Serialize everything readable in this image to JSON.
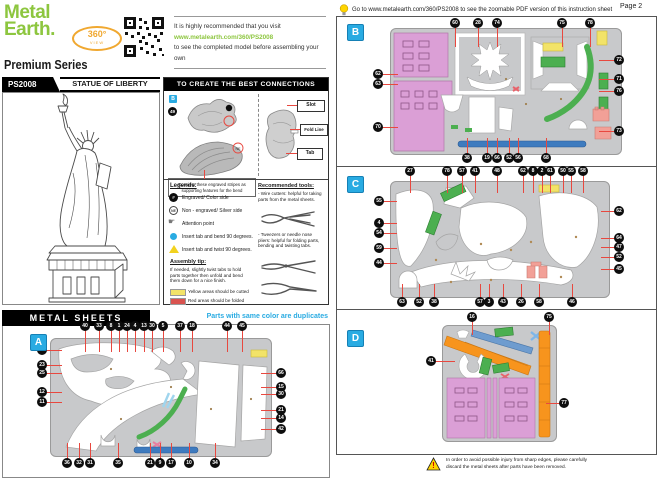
{
  "brand": {
    "logo_line1": "Metal",
    "logo_line2": "Earth.",
    "series": "Premium Series",
    "badge_360": "360°",
    "badge_view": "VIEW",
    "note_line1": "It is highly recommended that you visit",
    "note_link": "www.metalearth.com/360/PS2008",
    "note_line2": "to see the completed model before assembling your own"
  },
  "product": {
    "sku": "PS2008",
    "name": "STATUE OF LIBERTY"
  },
  "connections": {
    "title": "TO CREATE THE BEST CONNECTIONS",
    "badge_letter": "B",
    "part_number": "49",
    "ne_label": "NE",
    "caption": "Consider these engraved stripes as supporting features for the bend",
    "labels": {
      "slot": "Slot",
      "fold_line": "Fold Line",
      "tab": "Tab"
    }
  },
  "legends": {
    "title": "Legends:",
    "items": [
      {
        "icon": "engraved-circle-icon",
        "symbol": "#",
        "text": "Engraved/ Color side"
      },
      {
        "icon": "ne-circle-icon",
        "label": "NE",
        "text": "Non - engraved/ Silver side"
      },
      {
        "icon": "attention-hand-icon",
        "symbol": "☛",
        "text": "Attention point"
      },
      {
        "icon": "cyan-dot-icon",
        "text": "Insert tab and bend 90 degrees."
      },
      {
        "icon": "yellow-triangle-icon",
        "text": "Insert tab and twist 90 degrees."
      }
    ],
    "assembly_tip_title": "Assembly tip:",
    "assembly_tip": "If needed, slightly twist tabs to hold parts together then unfold and bend them down for a nice finish.",
    "yellow_note": "Yellow areas should be cutted",
    "red_note": "Red areas should be folded"
  },
  "tools": {
    "title": "Recommended tools:",
    "item1": "- Wire cutters: helpful for taking parts from the metal sheets.",
    "item2": "- Tweezers or needle nose pliers: helpful for folding parts, bending and twisting tabs."
  },
  "metal_sheets": {
    "title": "METAL SHEETS",
    "duplicates_note": "Parts with same color are duplicates"
  },
  "page_header": {
    "tip": "Go to www.metalearth.com/360/PS2008 to see the zoomable PDF version of this instruction sheet",
    "page": "Page 2"
  },
  "warning": {
    "line1": "In order to avoid possible injury from sharp edges, please carefully",
    "line2": "discard the metal sheets after parts have been removed."
  },
  "colors": {
    "brand_green": "#8DC63F",
    "accent_cyan": "#29ABE2",
    "callout_red": "#E8483F",
    "sheet_gray": "#C8C9CB",
    "part_pink": "#DB9FD6",
    "part_salmon": "#F2A097",
    "part_yellow": "#F2E368",
    "part_green": "#4CAF50",
    "part_blue": "#3E7BBF",
    "part_orange": "#F7941D"
  },
  "sheets": {
    "A": {
      "letter": "A",
      "callouts": {
        "top": {
          "len": 22,
          "items": [
            {
              "x": 85,
              "y": 326,
              "n": "40"
            },
            {
              "x": 99,
              "y": 326,
              "n": "33"
            },
            {
              "x": 111,
              "y": 326,
              "n": "8"
            },
            {
              "x": 119,
              "y": 326,
              "n": "1"
            },
            {
              "x": 127,
              "y": 326,
              "n": "24"
            },
            {
              "x": 135,
              "y": 326,
              "n": "4"
            },
            {
              "x": 144,
              "y": 326,
              "n": "13"
            },
            {
              "x": 152,
              "y": 326,
              "n": "30"
            },
            {
              "x": 163,
              "y": 326,
              "n": "5"
            },
            {
              "x": 180,
              "y": 326,
              "n": "37"
            },
            {
              "x": 192,
              "y": 326,
              "n": "18"
            },
            {
              "x": 227,
              "y": 326,
              "n": "44"
            },
            {
              "x": 242,
              "y": 326,
              "n": "45"
            }
          ]
        },
        "left": {
          "len": 16,
          "items": [
            {
              "x": 42,
              "y": 350,
              "n": "7"
            },
            {
              "x": 42,
              "y": 365,
              "n": "23"
            },
            {
              "x": 42,
              "y": 373,
              "n": "25"
            },
            {
              "x": 42,
              "y": 392,
              "n": "12"
            },
            {
              "x": 42,
              "y": 402,
              "n": "11"
            }
          ]
        },
        "right": {
          "len": 16,
          "items": [
            {
              "x": 281,
              "y": 373,
              "n": "66"
            },
            {
              "x": 281,
              "y": 387,
              "n": "15"
            },
            {
              "x": 281,
              "y": 394,
              "n": "30"
            },
            {
              "x": 281,
              "y": 410,
              "n": "21"
            },
            {
              "x": 281,
              "y": 418,
              "n": "14"
            },
            {
              "x": 281,
              "y": 429,
              "n": "42"
            }
          ]
        },
        "bottom": {
          "len": 16,
          "items": [
            {
              "x": 67,
              "y": 463,
              "n": "36"
            },
            {
              "x": 79,
              "y": 463,
              "n": "32"
            },
            {
              "x": 90,
              "y": 463,
              "n": "31"
            },
            {
              "x": 118,
              "y": 463,
              "n": "35"
            },
            {
              "x": 150,
              "y": 463,
              "n": "21"
            },
            {
              "x": 160,
              "y": 463,
              "n": "9"
            },
            {
              "x": 171,
              "y": 463,
              "n": "17"
            },
            {
              "x": 189,
              "y": 463,
              "n": "10"
            },
            {
              "x": 215,
              "y": 463,
              "n": "34"
            }
          ]
        }
      }
    },
    "B": {
      "letter": "B",
      "callouts": {
        "top": {
          "len": 20,
          "items": [
            {
              "x": 455,
              "y": 23,
              "n": "60"
            },
            {
              "x": 478,
              "y": 23,
              "n": "28"
            },
            {
              "x": 497,
              "y": 23,
              "n": "74"
            },
            {
              "x": 562,
              "y": 23,
              "n": "75"
            },
            {
              "x": 590,
              "y": 23,
              "n": "78"
            }
          ]
        },
        "left": {
          "len": 16,
          "items": [
            {
              "x": 378,
              "y": 74,
              "n": "62"
            },
            {
              "x": 378,
              "y": 84,
              "n": "63"
            },
            {
              "x": 378,
              "y": 127,
              "n": "70"
            }
          ]
        },
        "right": {
          "len": 16,
          "items": [
            {
              "x": 619,
              "y": 60,
              "n": "72"
            },
            {
              "x": 619,
              "y": 79,
              "n": "71"
            },
            {
              "x": 619,
              "y": 91,
              "n": "76"
            },
            {
              "x": 619,
              "y": 131,
              "n": "73"
            }
          ]
        },
        "bottom": {
          "len": 16,
          "items": [
            {
              "x": 467,
              "y": 158,
              "n": "38"
            },
            {
              "x": 487,
              "y": 158,
              "n": "19"
            },
            {
              "x": 497,
              "y": 158,
              "n": "66"
            },
            {
              "x": 509,
              "y": 158,
              "n": "52"
            },
            {
              "x": 518,
              "y": 158,
              "n": "56"
            },
            {
              "x": 546,
              "y": 158,
              "n": "68"
            }
          ]
        }
      }
    },
    "C": {
      "letter": "C",
      "callouts": {
        "top": {
          "len": 18,
          "items": [
            {
              "x": 410,
              "y": 171,
              "n": "27"
            },
            {
              "x": 447,
              "y": 171,
              "n": "78"
            },
            {
              "x": 462,
              "y": 171,
              "n": "57"
            },
            {
              "x": 475,
              "y": 171,
              "n": "41"
            },
            {
              "x": 497,
              "y": 171,
              "n": "48"
            },
            {
              "x": 523,
              "y": 171,
              "n": "62"
            },
            {
              "x": 533,
              "y": 171,
              "n": "8"
            },
            {
              "x": 542,
              "y": 171,
              "n": "2"
            },
            {
              "x": 550,
              "y": 171,
              "n": "61"
            },
            {
              "x": 563,
              "y": 171,
              "n": "50"
            },
            {
              "x": 571,
              "y": 171,
              "n": "55"
            },
            {
              "x": 583,
              "y": 171,
              "n": "58"
            }
          ]
        },
        "left": {
          "len": 14,
          "items": [
            {
              "x": 379,
              "y": 201,
              "n": "55"
            },
            {
              "x": 379,
              "y": 223,
              "n": "4"
            },
            {
              "x": 379,
              "y": 233,
              "n": "54"
            },
            {
              "x": 379,
              "y": 248,
              "n": "59"
            },
            {
              "x": 379,
              "y": 263,
              "n": "44"
            }
          ]
        },
        "right": {
          "len": 14,
          "items": [
            {
              "x": 619,
              "y": 211,
              "n": "62"
            },
            {
              "x": 619,
              "y": 238,
              "n": "64"
            },
            {
              "x": 619,
              "y": 247,
              "n": "47"
            },
            {
              "x": 619,
              "y": 257,
              "n": "52"
            },
            {
              "x": 619,
              "y": 269,
              "n": "45"
            }
          ]
        },
        "bottom": {
          "len": 14,
          "items": [
            {
              "x": 402,
              "y": 302,
              "n": "63"
            },
            {
              "x": 419,
              "y": 302,
              "n": "52"
            },
            {
              "x": 434,
              "y": 302,
              "n": "38"
            },
            {
              "x": 480,
              "y": 302,
              "n": "57"
            },
            {
              "x": 489,
              "y": 302,
              "n": "3"
            },
            {
              "x": 503,
              "y": 302,
              "n": "43"
            },
            {
              "x": 521,
              "y": 302,
              "n": "26"
            },
            {
              "x": 539,
              "y": 302,
              "n": "58"
            },
            {
              "x": 572,
              "y": 302,
              "n": "46"
            }
          ]
        }
      }
    },
    "D": {
      "letter": "D",
      "callouts": {
        "top": {
          "len": 14,
          "items": [
            {
              "x": 472,
              "y": 317,
              "n": "16"
            },
            {
              "x": 549,
              "y": 317,
              "n": "75"
            }
          ]
        },
        "left": {
          "len": 20,
          "items": [
            {
              "x": 431,
              "y": 361,
              "n": "41"
            }
          ]
        },
        "right": {
          "len": 14,
          "items": [
            {
              "x": 564,
              "y": 403,
              "n": "77"
            }
          ]
        }
      }
    }
  }
}
